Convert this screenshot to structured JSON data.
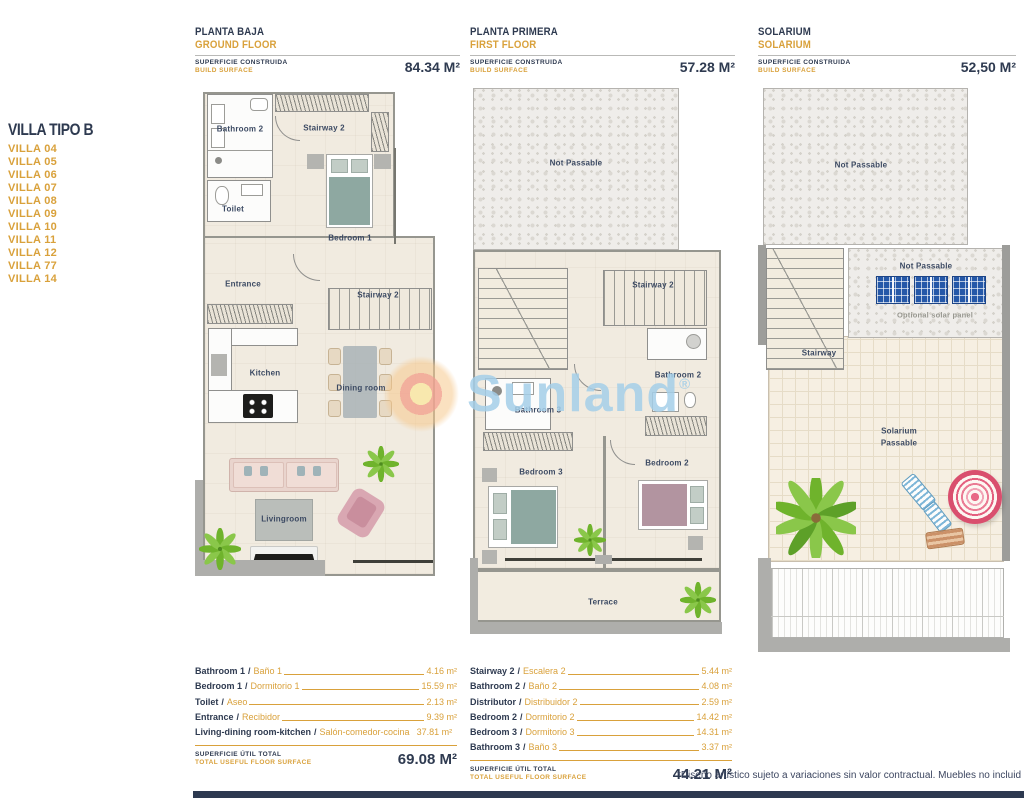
{
  "sidebar": {
    "title": "VILLA TIPO B",
    "villas": [
      "VILLA 04",
      "VILLA 05",
      "VILLA 06",
      "VILLA 07",
      "VILLA 08",
      "VILLA 09",
      "VILLA 10",
      "VILLA 11",
      "VILLA 12",
      "VILLA 77",
      "VILLA 14"
    ]
  },
  "plans": [
    {
      "title_es": "PLANTA BAJA",
      "title_en": "GROUND FLOOR",
      "surface_es": "SUPERFICIE CONSTRUIDA",
      "surface_en": "BUILD SURFACE",
      "area": "84.34 M²",
      "labels": {
        "bathroom2": "Bathroom 2",
        "stairway2_top": "Stairway 2",
        "toilet": "Toilet",
        "bedroom1": "Bedroom 1",
        "entrance": "Entrance",
        "stairway2_mid": "Stairway 2",
        "kitchen": "Kitchen",
        "dining": "Dining room",
        "living": "Livingroom"
      }
    },
    {
      "title_es": "PLANTA PRIMERA",
      "title_en": "FIRST FLOOR",
      "surface_es": "SUPERFICIE CONSTRUIDA",
      "surface_en": "BUILD SURFACE",
      "area": "57.28 M²",
      "labels": {
        "not_passable": "Not Passable",
        "stairway2": "Stairway 2",
        "bathroom2": "Bathroom 2",
        "bathroom3": "Bathroom 3",
        "bedroom2": "Bedroom 2",
        "bedroom3": "Bedroom 3",
        "terrace": "Terrace"
      }
    },
    {
      "title_es": "SOLARIUM",
      "title_en": "SOLARIUM",
      "surface_es": "SUPERFICIE CONSTRUIDA",
      "surface_en": "BUILD SURFACE",
      "area": "52,50 M²",
      "labels": {
        "not_passable_top": "Not Passable",
        "not_passable_strip": "Not Passable",
        "optional_solar": "Optional solar panel",
        "stairway": "Stairway",
        "solarium1": "Solarium",
        "solarium2": "Passable"
      }
    }
  ],
  "tables": [
    {
      "rows": [
        {
          "en": "Bathroom 1",
          "es": "Baño 1",
          "area": "4.16 m²"
        },
        {
          "en": "Bedroom 1",
          "es": "Dormitorio 1",
          "area": "15.59 m²"
        },
        {
          "en": "Toilet",
          "es": "Aseo",
          "area": "2.13 m²"
        },
        {
          "en": "Entrance",
          "es": "Recibidor",
          "area": "9.39 m²"
        },
        {
          "en": "Living-dining room-kitchen",
          "es": "Salón-comedor-cocina",
          "area": "37.81 m²"
        }
      ],
      "total_es": "SUPERFICIE ÚTIL TOTAL",
      "total_en": "TOTAL USEFUL FLOOR SURFACE",
      "total": "69.08 M²"
    },
    {
      "rows": [
        {
          "en": "Stairway 2",
          "es": "Escalera 2",
          "area": "5.44 m²"
        },
        {
          "en": "Bathroom 2",
          "es": "Baño 2",
          "area": "4.08 m²"
        },
        {
          "en": "Distributor",
          "es": "Distribuidor 2",
          "area": "2.59 m²"
        },
        {
          "en": "Bedroom 2",
          "es": "Dormitorio 2",
          "area": "14.42 m²"
        },
        {
          "en": "Bedroom 3",
          "es": "Dormitorio 3",
          "area": "14.31 m²"
        },
        {
          "en": "Bathroom 3",
          "es": "Baño 3",
          "area": "3.37 m²"
        }
      ],
      "total_es": "SUPERFICIE ÚTIL TOTAL",
      "total_en": "TOTAL USEFUL FLOOR SURFACE",
      "total": "44.21 M²"
    }
  ],
  "watermark": {
    "text": "Sunland",
    "reg": "®"
  },
  "footer": {
    "disclaimer": "*Diseño artístico sujeto a variaciones sin valor contractual. Muebles no incluid"
  },
  "misc": {
    "sep": "/"
  },
  "colors": {
    "navy": "#2e3a50",
    "gold": "#d9a13b",
    "watermark_blue": "#a5cfe9",
    "teal_bed": "#8ea8a1",
    "mauve_bed": "#b294a0",
    "panel_blue": "#2558a8"
  }
}
